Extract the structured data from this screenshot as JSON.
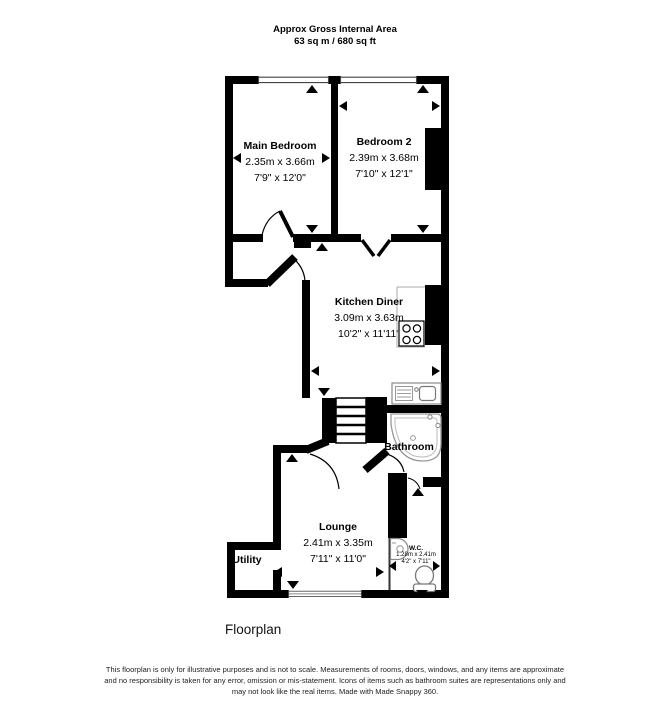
{
  "title": {
    "line1": "Approx Gross Internal Area",
    "line2": "63 sq m / 680 sq ft"
  },
  "rooms": {
    "main_bedroom": {
      "name": "Main Bedroom",
      "metric": "2.35m x 3.66m",
      "imperial": "7'9\" x 12'0\""
    },
    "bedroom2": {
      "name": "Bedroom 2",
      "metric": "2.39m x 3.68m",
      "imperial": "7'10\" x 12'1\""
    },
    "kitchen": {
      "name": "Kitchen Diner",
      "metric": "3.09m x 3.63m",
      "imperial": "10'2\" x 11'11\""
    },
    "bathroom": {
      "name": "Bathroom"
    },
    "lounge": {
      "name": "Lounge",
      "metric": "2.41m x 3.35m",
      "imperial": "7'11\" x 11'0\""
    },
    "utility": {
      "name": "Utility"
    },
    "wc": {
      "name": "W.C.",
      "metric": "1.28m x 2.41m",
      "imperial": "4'2\" x 7'11\""
    }
  },
  "footer": {
    "caption": "Floorplan",
    "disclaimer_lines": [
      "This floorplan is only for illustrative purposes and is not to scale. Measurements of rooms, doors, windows, and any items are approximate",
      "and no responsibility is taken for any error, omission or mis-statement. Icons of items such as bathroom suites are representations only and",
      "may not look like the real items. Made with Made Snappy 360."
    ]
  },
  "icons": {
    "bath": "corner-bath-icon",
    "toilet": "toilet-icon",
    "basin": "hand-basin-icon",
    "hob": "hob-icon",
    "sink": "kitchen-sink-icon",
    "stairs": "stairs-icon"
  },
  "colors": {
    "wall": "#000000",
    "icon_stroke": "#8c8c8c",
    "text": "#000000",
    "disclaimer_text": "#222222"
  }
}
